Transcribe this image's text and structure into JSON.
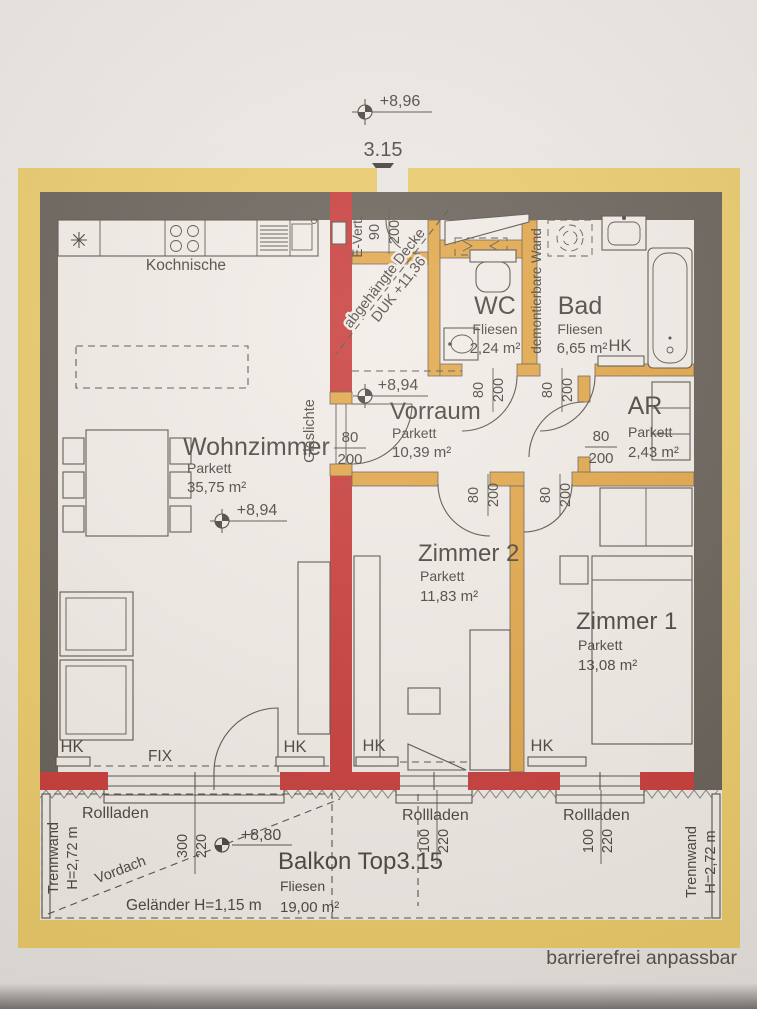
{
  "plan": {
    "unit_number": "3.15",
    "site_elevation": "+8,96",
    "footer_note": "barrierefrei anpassbar"
  },
  "rooms": {
    "kochnische": {
      "name": "Kochnische"
    },
    "wohnzimmer": {
      "name": "Wohnzimmer",
      "floor": "Parkett",
      "area": "35,75 m²",
      "level": "+8,94"
    },
    "vorraum": {
      "name": "Vorraum",
      "floor": "Parkett",
      "area": "10,39 m²",
      "level": "+8,94"
    },
    "wc": {
      "name": "WC",
      "floor": "Fliesen",
      "area": "2,24 m²"
    },
    "bad": {
      "name": "Bad",
      "floor": "Fliesen",
      "area": "6,65 m²"
    },
    "ar": {
      "name": "AR",
      "floor": "Parkett",
      "area": "2,43 m²"
    },
    "zimmer2": {
      "name": "Zimmer 2",
      "floor": "Parkett",
      "area": "11,83 m²"
    },
    "zimmer1": {
      "name": "Zimmer 1",
      "floor": "Parkett",
      "area": "13,08 m²"
    },
    "balkon": {
      "name": "Balkon Top3.15",
      "floor": "Fliesen",
      "area": "19,00 m²",
      "level": "+8,80"
    }
  },
  "labels": {
    "hk": "HK",
    "fix": "FIX",
    "rollladen": "Rollladen",
    "e_vert": "E-Vert.",
    "glaslichte": "Glaslichte",
    "demontierbare_wand": "demontierbare Wand",
    "abgehaengte_decke": "abgehängte Decke",
    "duk": "DUK +11,36",
    "vordach": "Vordach",
    "gelaender": "Geländer H=1,15 m",
    "trennwand": "Trennwand",
    "trennwand_h": "H=2,72 m"
  },
  "dims": {
    "d80": "80",
    "d90": "90",
    "d100": "100",
    "d200": "200",
    "d220": "220",
    "d300": "300"
  },
  "icons": {
    "appliance_star": "✳"
  },
  "colors": {
    "paper": "#eae6e2",
    "insulation_yellow": "#e9c75f",
    "wall_dark": "#5a534c",
    "wall_red": "#c32b2a",
    "wall_orange": "#e0a03c",
    "ink": "#3b3631"
  }
}
